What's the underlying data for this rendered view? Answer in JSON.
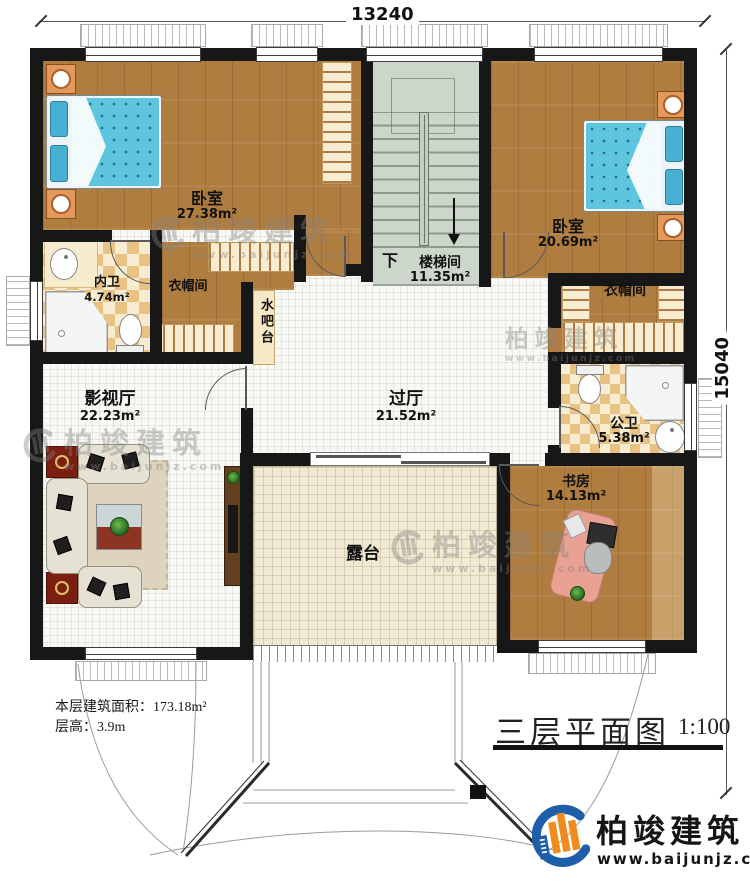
{
  "title_block": {
    "title": "三层平面图",
    "scale": "1:100"
  },
  "notes": {
    "floor_area": "本层建筑面积：173.18m²",
    "floor_height": "层高：3.9m"
  },
  "dimensions": {
    "width_mm": "13240",
    "height_mm": "15040"
  },
  "rooms": {
    "bedroom_left": {
      "name": "卧室",
      "area": "27.38m²"
    },
    "inner_bath": {
      "name": "内卫",
      "area": "4.74m²"
    },
    "closet_left": {
      "name": "衣帽间"
    },
    "water_bar": {
      "name": "水吧台"
    },
    "stairwell": {
      "name": "楼梯间",
      "area": "11.35m²",
      "direction": "下"
    },
    "bedroom_right": {
      "name": "卧室",
      "area": "20.69m²"
    },
    "closet_right": {
      "name": "衣帽间"
    },
    "public_bath": {
      "name": "公卫",
      "area": "5.38m²"
    },
    "hallway": {
      "name": "过厅",
      "area": "21.52m²"
    },
    "media_room": {
      "name": "影视厅",
      "area": "22.23m²"
    },
    "terrace": {
      "name": "露台"
    },
    "study": {
      "name": "书房",
      "area": "14.13m²"
    }
  },
  "branding": {
    "company": "柏竣建筑",
    "website": "www.baijunjz.com"
  },
  "colors": {
    "wall": "#171717",
    "wood": "#b07d40",
    "stair": "#ccd6ca",
    "terrace": "#f0e9d4",
    "accent_blue": "#1d5fa8",
    "accent_orange": "#f08c1e"
  }
}
